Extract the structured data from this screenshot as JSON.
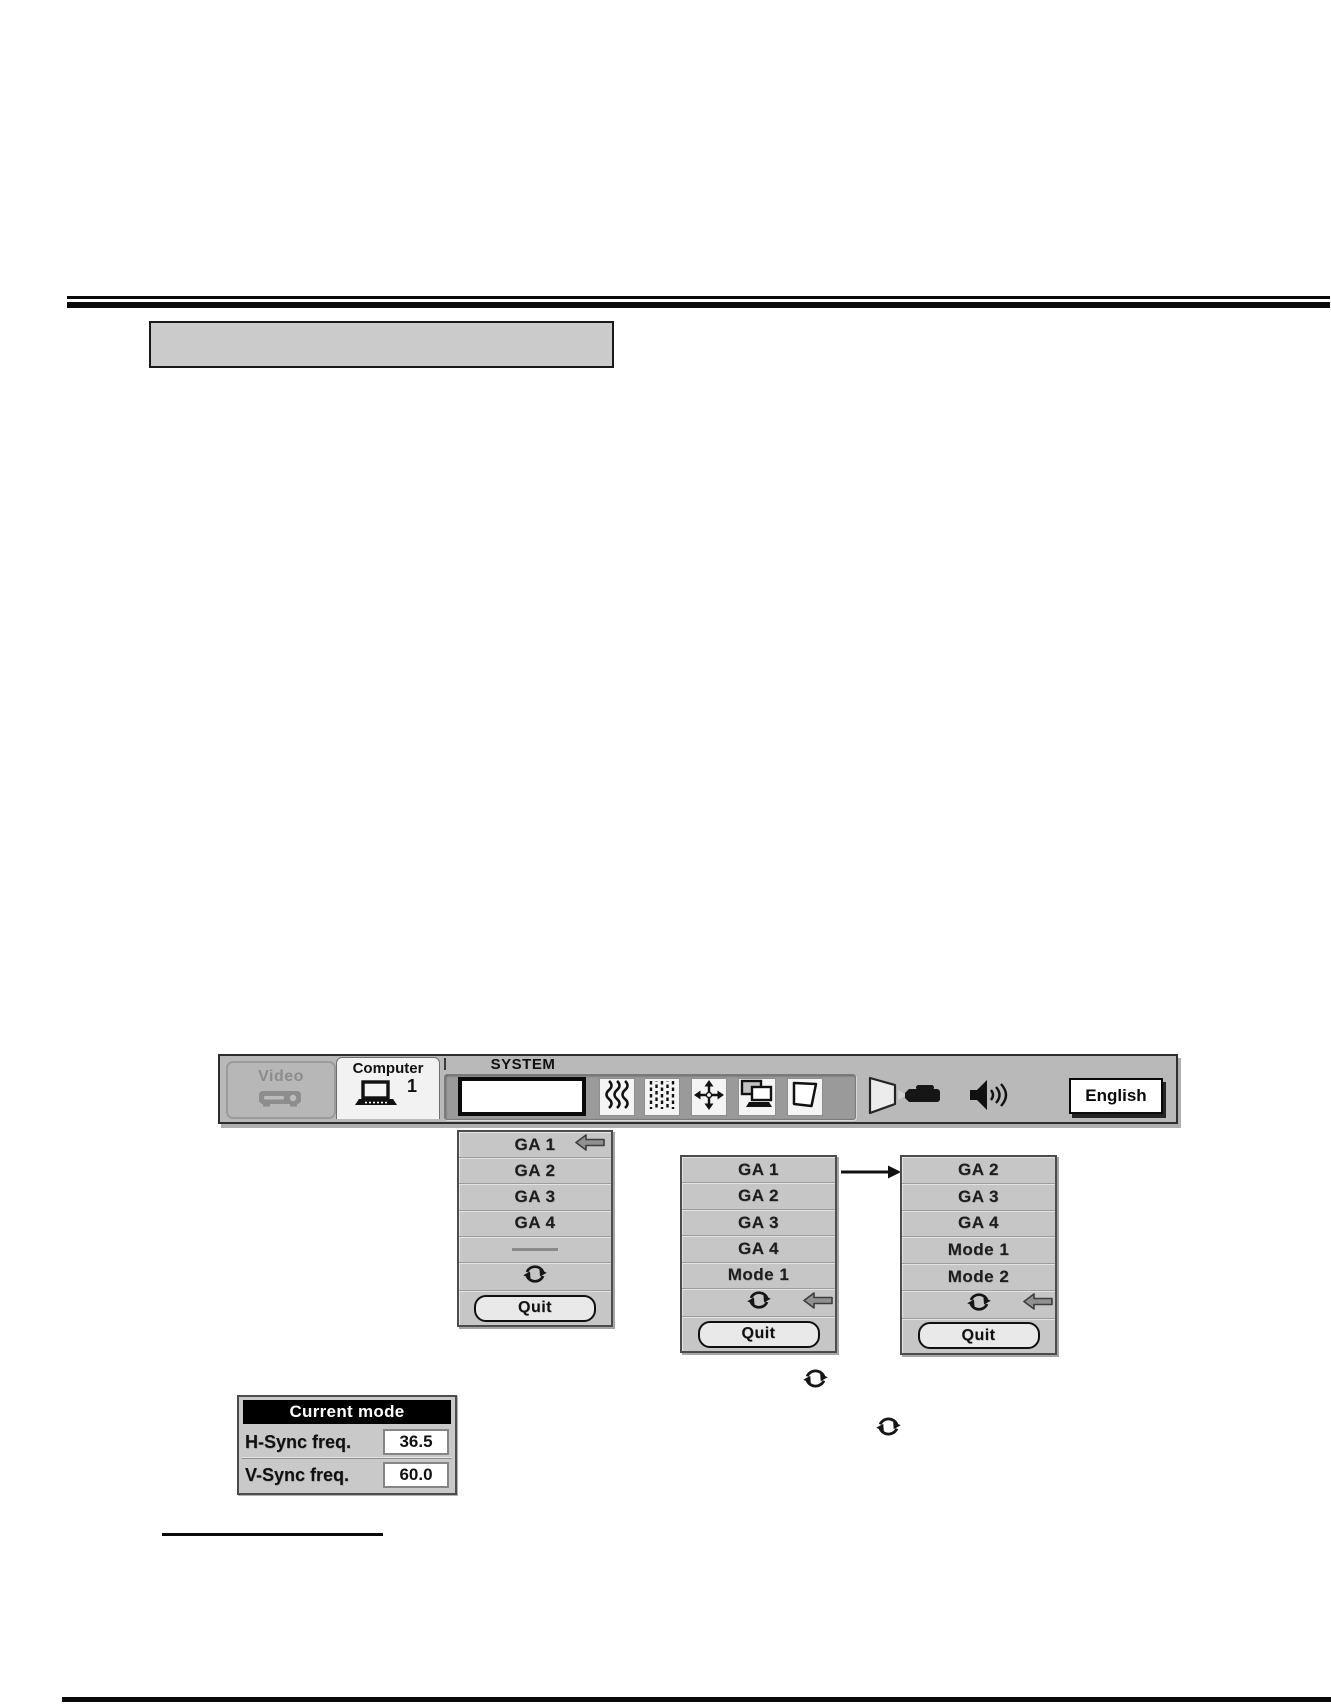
{
  "title_box": {
    "visible_text": ""
  },
  "menu_bar": {
    "video_label": "Video",
    "computer_label": "Computer",
    "computer_number": "1",
    "system_label": "SYSTEM",
    "english_label": "English",
    "icons": [
      "vcr-icon",
      "laptop-icon",
      "fine-sync-icon",
      "total-dots-icon",
      "position-icon",
      "pc-adjust-icon",
      "screen-shape-icon",
      "projection-icon",
      "volume-icon"
    ],
    "colors": {
      "bar_bg": "#b9b9b9",
      "recessed_bg": "#9a9a9a",
      "disabled_text": "#8c8c8c"
    }
  },
  "menus": [
    {
      "items": [
        "GA 1",
        "GA 2",
        "GA 3",
        "GA 4"
      ],
      "selected_item": "GA 1",
      "quit_label": "Quit"
    },
    {
      "items": [
        "GA 1",
        "GA 2",
        "GA 3",
        "GA 4",
        "Mode 1"
      ],
      "quit_label": "Quit"
    },
    {
      "items": [
        "GA 2",
        "GA 3",
        "GA 4",
        "Mode 1",
        "Mode 2"
      ],
      "quit_label": "Quit"
    }
  ],
  "current_mode": {
    "title": "Current mode",
    "rows": [
      {
        "label": "H-Sync freq.",
        "value": "36.5"
      },
      {
        "label": "V-Sync freq.",
        "value": "60.0"
      }
    ]
  },
  "colors": {
    "panel_gray": "#c6c6c6",
    "header_bg": "#000000",
    "header_text": "#ffffff",
    "accent_black": "#0a0a0a"
  }
}
